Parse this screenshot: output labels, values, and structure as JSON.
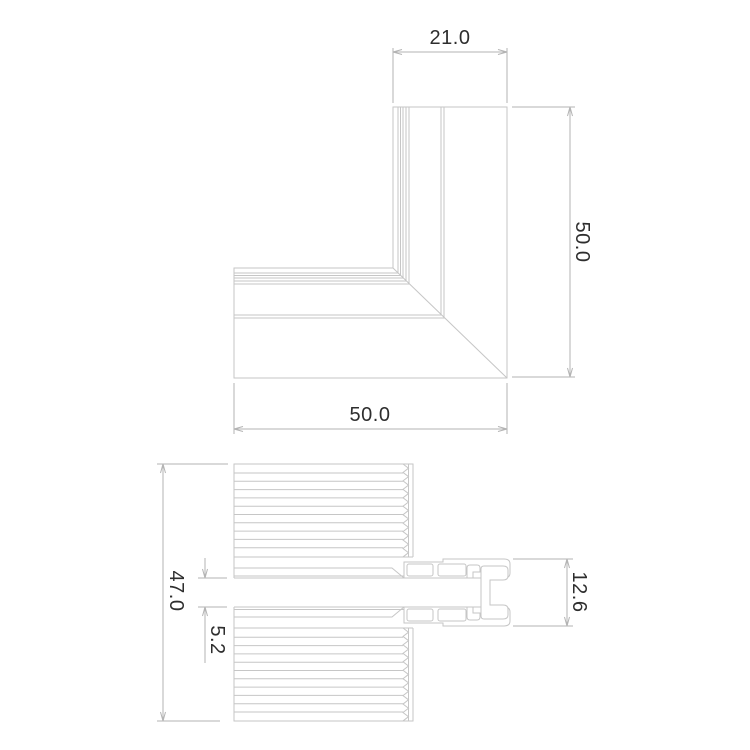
{
  "drawing": {
    "type": "technical-cad-drawing",
    "background": "#ffffff",
    "profile_line_color": "#c6c6c6",
    "dimension_line_color": "#b3b3b3",
    "text_color": "#2e2e2e",
    "views": [
      {
        "id": "corner-top-view",
        "description": "L-shaped mitred corner profile, plan view",
        "dimensions": [
          {
            "label": "21.0",
            "edge": "top"
          },
          {
            "label": "50.0",
            "edge": "right"
          },
          {
            "label": "50.0",
            "edge": "bottom"
          }
        ]
      },
      {
        "id": "corner-section-view",
        "description": "Ribbed sash cross-section with corner connector",
        "dimensions": [
          {
            "label": "47.0",
            "edge": "left"
          },
          {
            "label": "5.2",
            "edge": "left-slot"
          },
          {
            "label": "12.6",
            "edge": "right"
          }
        ]
      }
    ],
    "labels": {
      "dim_21": "21.0",
      "dim_50_right": "50.0",
      "dim_50_bottom": "50.0",
      "dim_47": "47.0",
      "dim_5_2": "5.2",
      "dim_12_6": "12.6"
    }
  }
}
